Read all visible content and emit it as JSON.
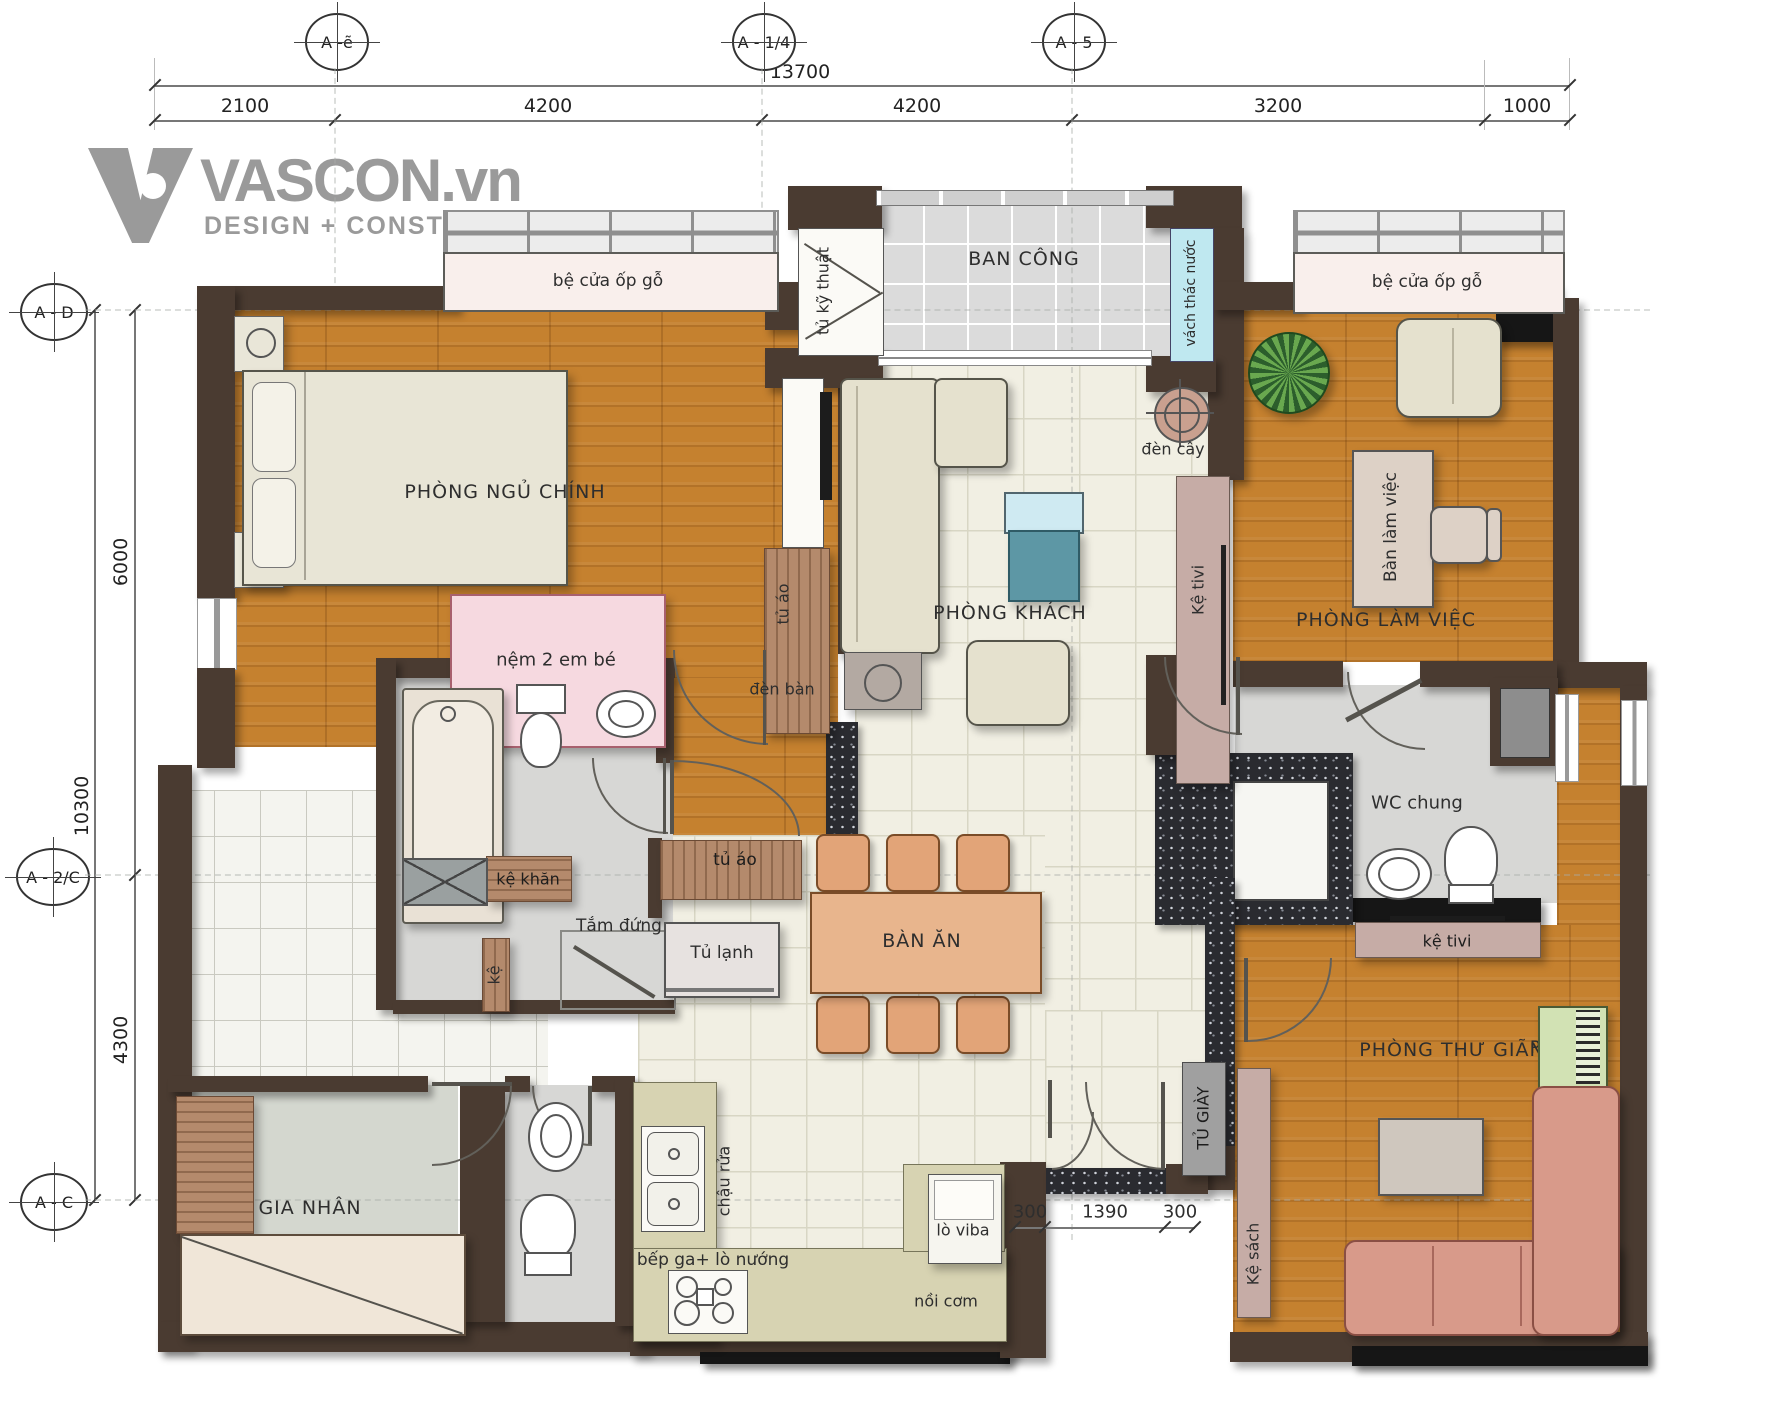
{
  "logo": {
    "brand": "VASCON.vn",
    "tagline": "DESIGN + CONSTRUCTION"
  },
  "axes": {
    "top": [
      "A -ẽ",
      "A - 1/4",
      "A - 5"
    ],
    "left": [
      "A - D",
      "A - 2/C",
      "A - C"
    ]
  },
  "dims": {
    "total": "13700",
    "top": [
      "2100",
      "4200",
      "4200",
      "3200",
      "1000"
    ],
    "left_outer": "10300",
    "left_upper": "6000",
    "left_lower": "4300",
    "entry": [
      "300",
      "1390",
      "300"
    ]
  },
  "rooms": {
    "master_bedroom": "PHÒNG NGỦ CHÍNH",
    "living_room": "PHÒNG KHÁCH",
    "office": "PHÒNG LÀM VIỆC",
    "relax_room": "PHÒNG THƯ GIÃN",
    "balcony": "BAN CÔNG",
    "shared_wc": "WC chung",
    "maid_room": "GIA NHÂN",
    "dining_table": "BÀN ĂN"
  },
  "labels": {
    "window_sill": "bệ cửa ốp gỗ",
    "tech_cabinet": "tủ kỹ thuật",
    "water_feature_wall": "vách thác nước",
    "floor_lamp": "đèn cây",
    "table_lamp": "đèn bàn",
    "wardrobe": "tủ áo",
    "tv_shelf_living": "Kệ tivi",
    "tv_shelf_small": "kệ tivi",
    "work_desk": "Bàn làm việc",
    "baby_mattress": "nệm 2 em bé",
    "towel_shelf": "kệ khăn",
    "standing_shower": "Tắm đứng",
    "small_shelf": "kệ",
    "fridge": "Tủ lạnh",
    "kitchen_sink": "chậu rửa",
    "gas_stove": "bếp ga+ lò nướng",
    "rice_cooker": "nồi cơm",
    "microwave": "lò viba",
    "shoe_cabinet": "TỦ GIÀY",
    "bookshelf": "Kệ sách",
    "piano": "Piano"
  },
  "colors": {
    "wall": "#4a3b31",
    "wood_floor": "#c5812f",
    "tile_floor": "#f1efe3",
    "balcony_tile": "#dbdbdb",
    "granite": "#26272b",
    "water_wall": "#bfe8f0",
    "window_sill": "#f9efec",
    "logo_gray": "#9a9a9a"
  }
}
